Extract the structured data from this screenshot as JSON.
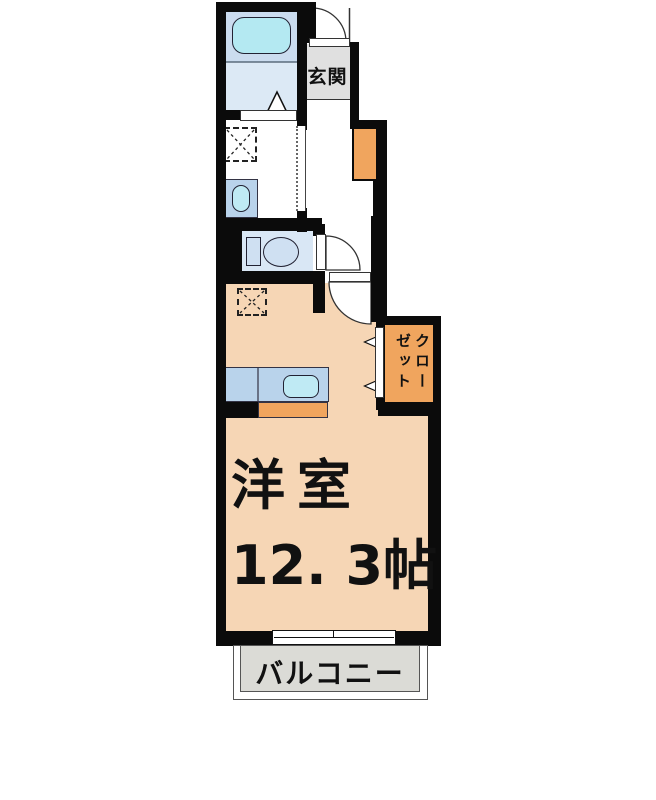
{
  "floorplan": {
    "labels": {
      "entrance": "玄関",
      "main_room_name": "洋室",
      "main_room_size": "12. 3帖",
      "balcony": "バルコニー",
      "closet_full": "クローゼット",
      "closet_columns": [
        "クロー",
        "ゼット"
      ]
    },
    "icon_names": [
      "bathtub-icon",
      "washbasin-icon",
      "toilet-icon",
      "kitchen-sink-icon",
      "washing-machine-space-icon",
      "refrigerator-space-icon",
      "door-swing-arc-icon",
      "folding-door-triangle-icon",
      "sliding-door-icon",
      "sliding-window-icon",
      "closet-arrow-icon"
    ],
    "colors": {
      "wall": "#0b0b0b",
      "main_room_fill": "#f6d6b5",
      "accent_orange": "#f0a55e",
      "bathroom_fill": "#dce9f5",
      "bathroom_upper_fill": "#cbdcef",
      "bathtub_fill": "#b4e9f2",
      "fixture_blue": "#b9d3eb",
      "sink_cyan": "#bfeaf4",
      "toilet_room_fill": "#d9e7f5",
      "entrance_fill": "#e0e0e0",
      "balcony_fill": "#dbdbd6"
    }
  }
}
